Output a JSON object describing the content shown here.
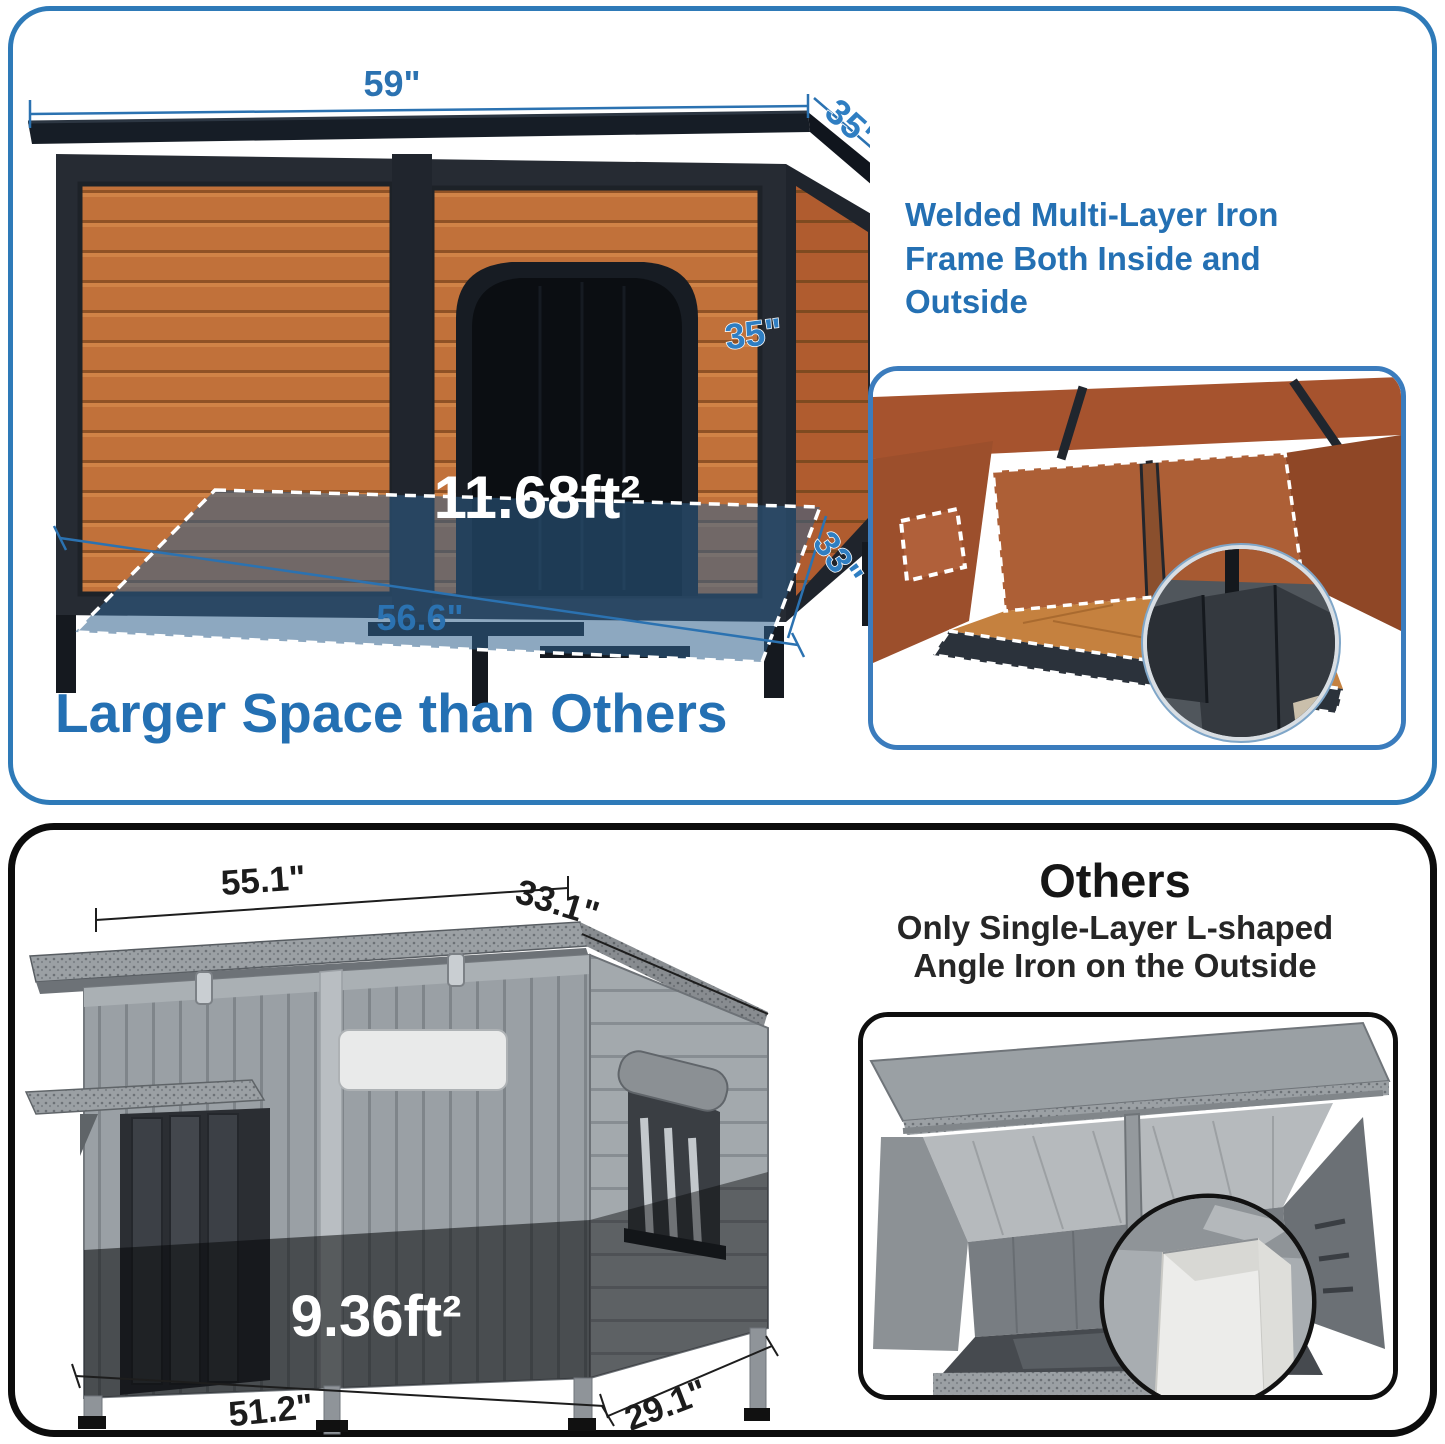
{
  "colors": {
    "accent_blue": "#2470B3",
    "panel_top_border": "#2E7AB8",
    "panel_bottom_border": "#0C0C0C",
    "wood_orange": "#C1713A",
    "iron_frame": "#262B33",
    "floor_overlay_blue": "#2F618D",
    "others_text": "#161616"
  },
  "top_panel": {
    "headline": "Larger Space than Others",
    "callout_line1": "Welded Multi-Layer Iron",
    "callout_line2": "Frame Both Inside and",
    "callout_line3": "Outside",
    "dims": {
      "roof_width": "59\"",
      "roof_depth": "35\"",
      "height": "35\"",
      "floor_area": "11.68ft²",
      "floor_width": "56.6\"",
      "floor_depth": "33\""
    }
  },
  "bottom_panel": {
    "title": "Others",
    "subtitle_line1": "Only Single-Layer L-shaped",
    "subtitle_line2": "Angle Iron on the Outside",
    "dims": {
      "roof_width": "55.1\"",
      "roof_depth": "33.1\"",
      "floor_area": "9.36ft²",
      "floor_width": "51.2\"",
      "floor_depth": "29.1\""
    }
  }
}
